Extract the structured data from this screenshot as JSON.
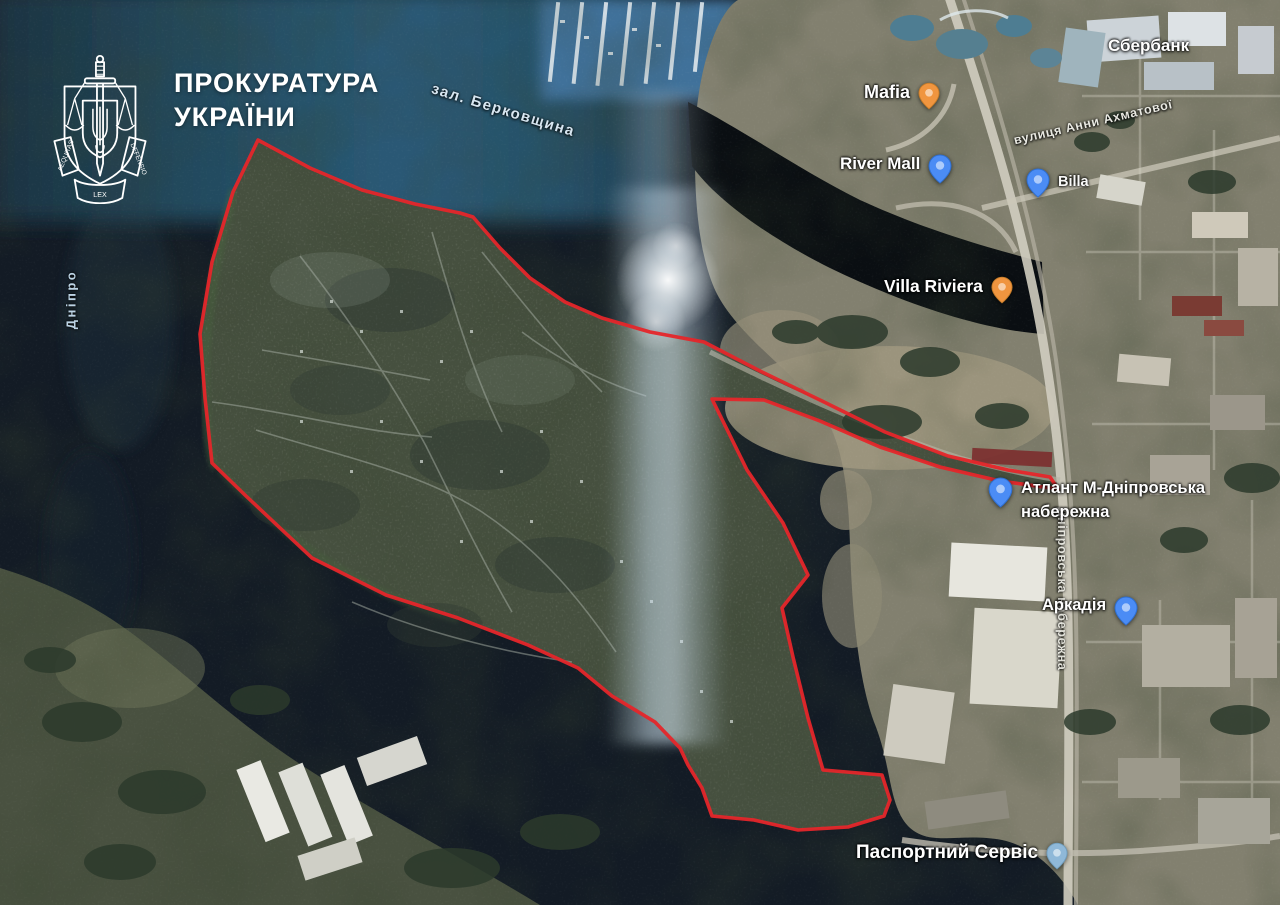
{
  "watermark": {
    "title_line1": "ПРОКУРАТУРА",
    "title_line2": "УКРАЇНИ",
    "motto_left": "AEQUITAS",
    "motto_center": "LEX",
    "motto_right": "DEFENSIO"
  },
  "map": {
    "water_labels": {
      "bay": "зал. Берковщина",
      "river": "Дніпро"
    },
    "street_labels": {
      "akhmatova": "вулиця Анни Ахматової",
      "embankment": "Дніпровська набережна"
    },
    "poi": [
      {
        "name": "mafia",
        "text": "Mafia",
        "pin": "orange"
      },
      {
        "name": "river-mall",
        "text": "River Mall",
        "pin": "blue"
      },
      {
        "name": "sberbank",
        "text": "Сбербанк",
        "pin": "none"
      },
      {
        "name": "billa",
        "text": "Billa",
        "pin": "blue"
      },
      {
        "name": "villa-riviera",
        "text": "Villa Riviera",
        "pin": "orange"
      },
      {
        "name": "atlant",
        "text": "Атлант М-Дніпровська набережна",
        "pin": "blue"
      },
      {
        "name": "arkadia",
        "text": "Аркадія",
        "pin": "blue"
      },
      {
        "name": "passport-service",
        "text": "Паспортний Сервіс",
        "pin": "blue"
      }
    ],
    "boundary": {
      "color": "#e5262a",
      "points": [
        [
          258,
          140
        ],
        [
          310,
          168
        ],
        [
          362,
          190
        ],
        [
          415,
          204
        ],
        [
          460,
          213
        ],
        [
          473,
          217
        ],
        [
          500,
          248
        ],
        [
          530,
          278
        ],
        [
          565,
          302
        ],
        [
          602,
          318
        ],
        [
          650,
          332
        ],
        [
          704,
          342
        ],
        [
          760,
          371
        ],
        [
          822,
          401
        ],
        [
          885,
          432
        ],
        [
          948,
          456
        ],
        [
          1008,
          470
        ],
        [
          1050,
          477
        ],
        [
          1058,
          489
        ],
        [
          1000,
          481
        ],
        [
          940,
          467
        ],
        [
          880,
          447
        ],
        [
          820,
          421
        ],
        [
          764,
          400
        ],
        [
          712,
          399
        ],
        [
          747,
          470
        ],
        [
          783,
          523
        ],
        [
          808,
          575
        ],
        [
          782,
          608
        ],
        [
          793,
          657
        ],
        [
          808,
          718
        ],
        [
          823,
          770
        ],
        [
          882,
          775
        ],
        [
          890,
          800
        ],
        [
          884,
          816
        ],
        [
          848,
          827
        ],
        [
          798,
          830
        ],
        [
          754,
          820
        ],
        [
          712,
          816
        ],
        [
          702,
          788
        ],
        [
          688,
          765
        ],
        [
          680,
          748
        ],
        [
          655,
          722
        ],
        [
          612,
          696
        ],
        [
          578,
          668
        ],
        [
          528,
          645
        ],
        [
          458,
          618
        ],
        [
          386,
          595
        ],
        [
          312,
          558
        ],
        [
          246,
          496
        ],
        [
          212,
          463
        ],
        [
          205,
          398
        ],
        [
          200,
          334
        ],
        [
          212,
          262
        ],
        [
          233,
          192
        ]
      ]
    }
  },
  "colors": {
    "pin_orange": "#f0953f",
    "pin_blue": "#4b8cf5",
    "pin_pale_blue": "#8fb8d8",
    "label_text": "#ffffff",
    "boundary_red": "#e5262a"
  }
}
